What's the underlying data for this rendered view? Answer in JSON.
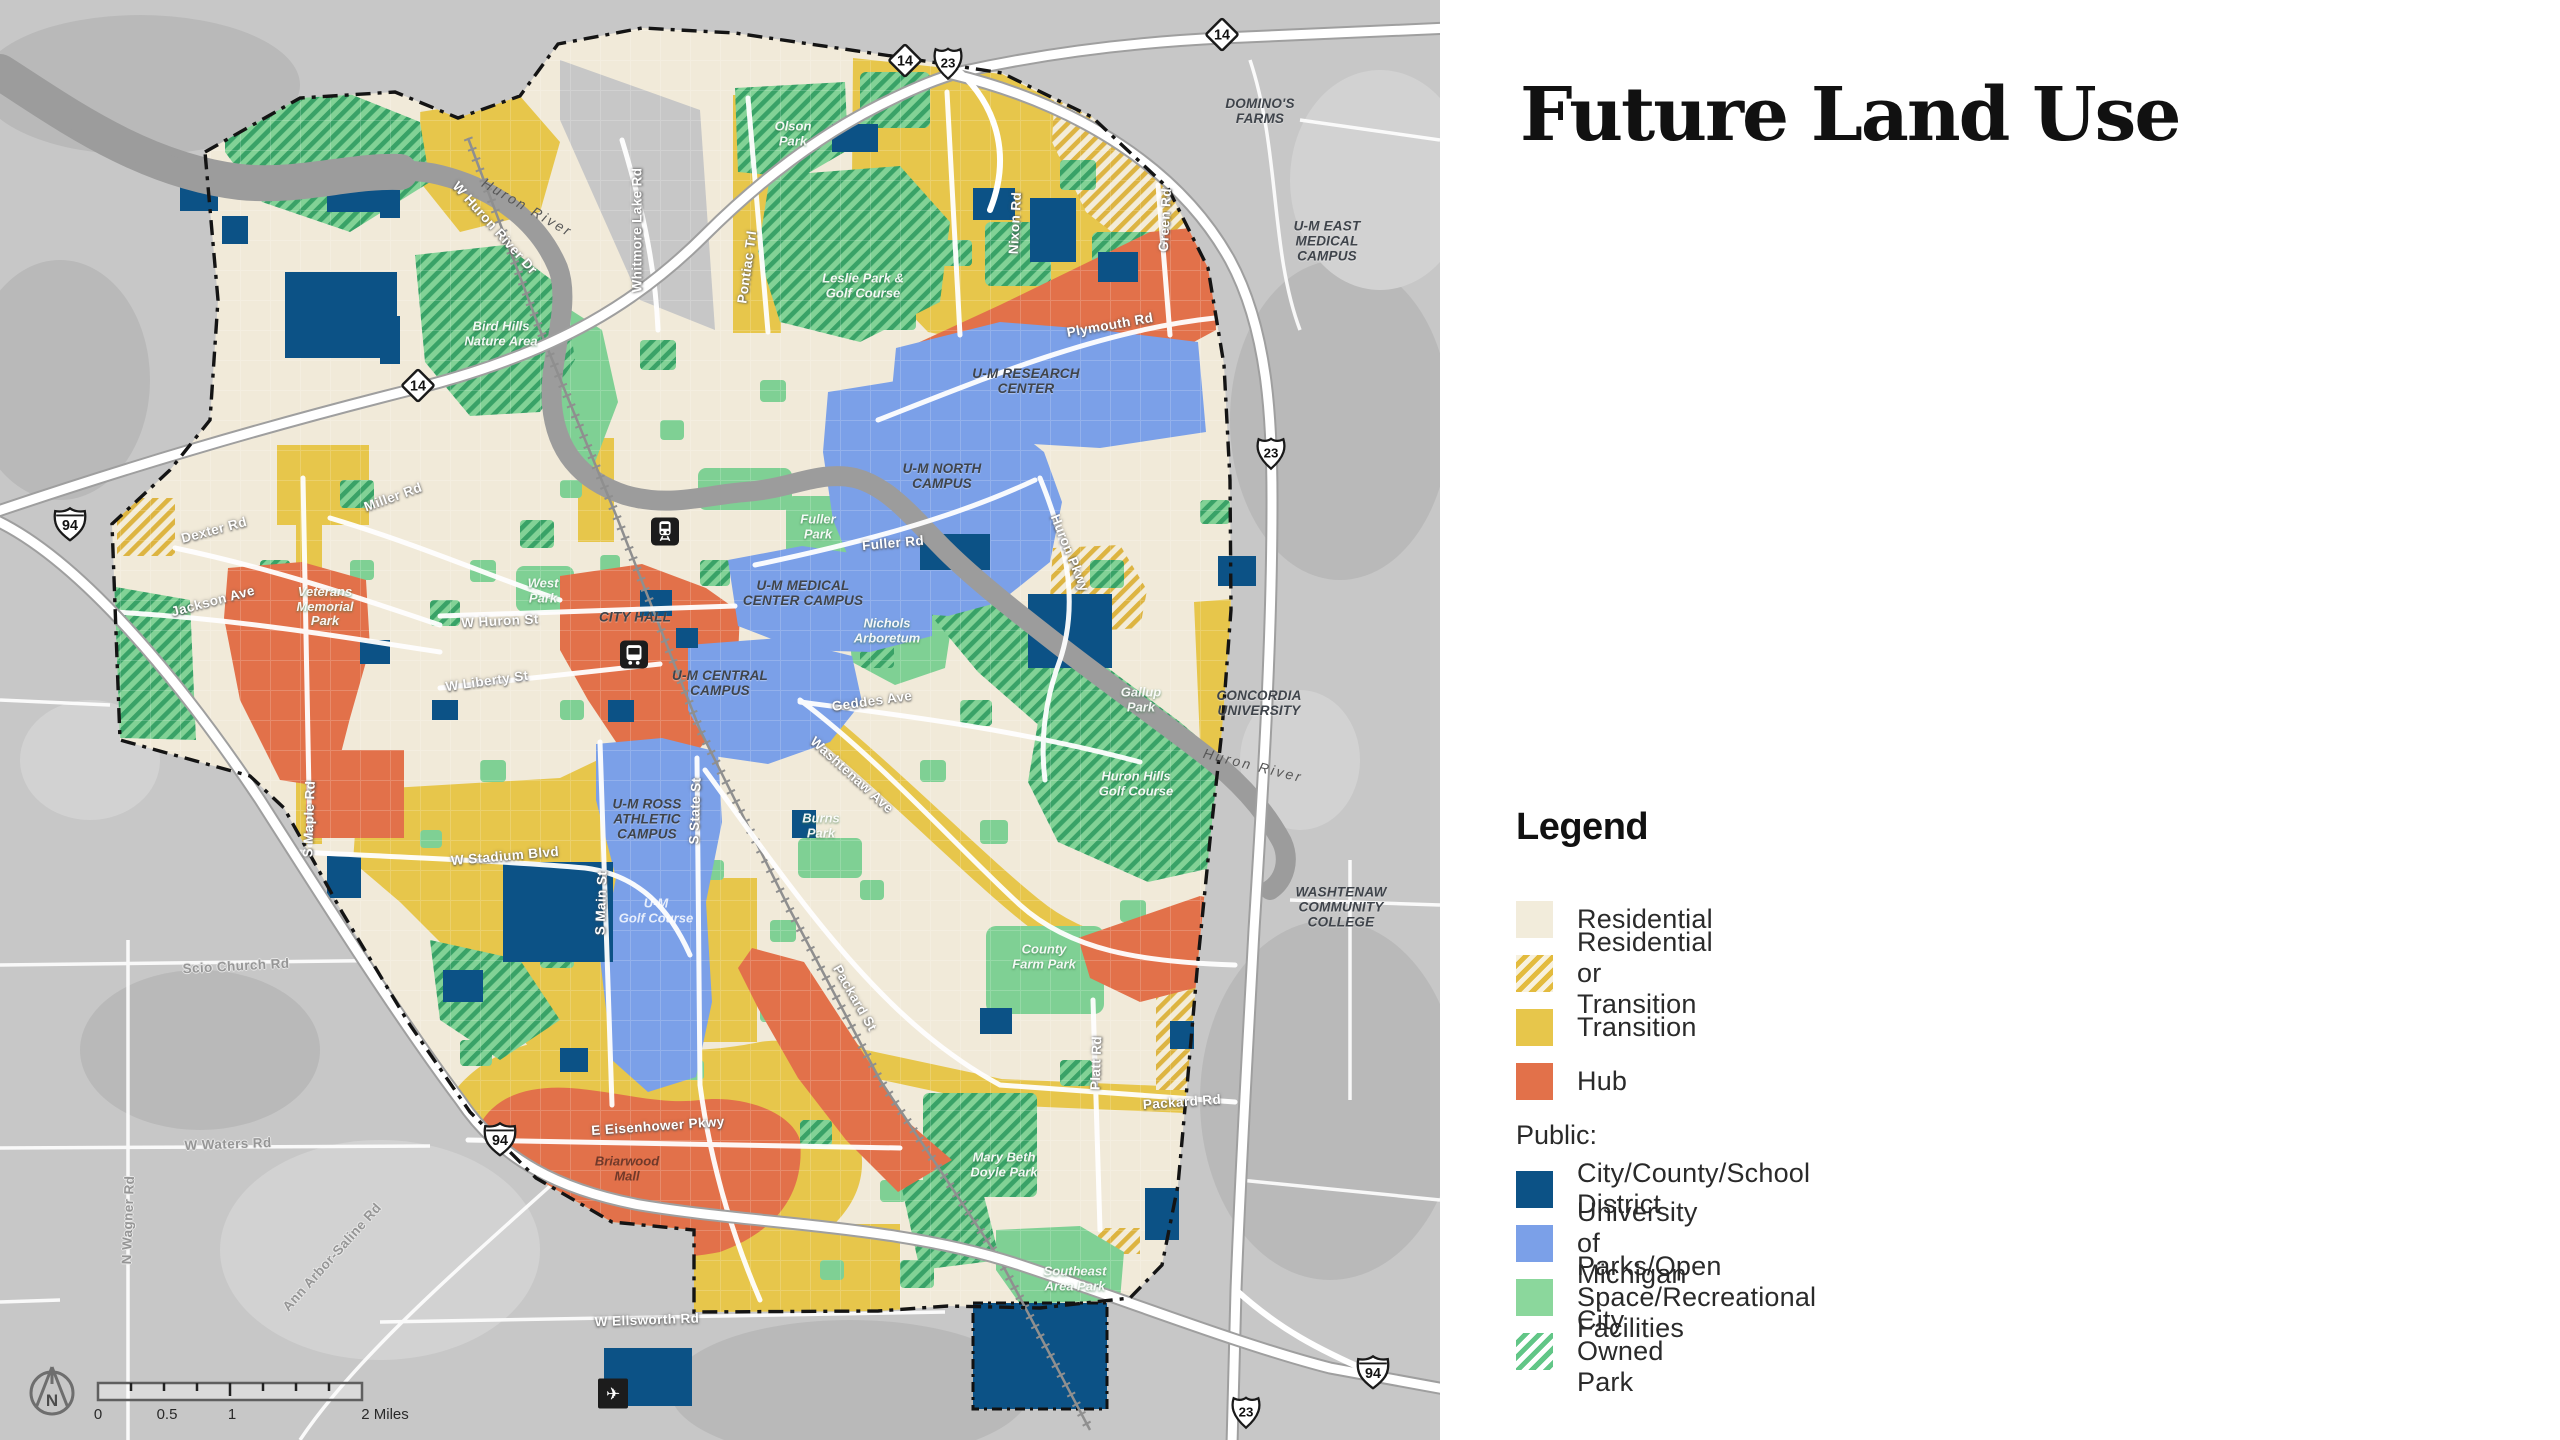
{
  "panel": {
    "title": "Future Land Use",
    "legend": {
      "heading": "Legend",
      "items": [
        {
          "kind": "item",
          "swatch": "residential",
          "label": "Residential"
        },
        {
          "kind": "item",
          "swatch": "residential-or-transition",
          "label": "Residential or Transition"
        },
        {
          "kind": "item",
          "swatch": "transition",
          "label": "Transition"
        },
        {
          "kind": "item",
          "swatch": "hub",
          "label": "Hub"
        },
        {
          "kind": "subheading",
          "label": "Public:"
        },
        {
          "kind": "item",
          "swatch": "city-county-school",
          "label": "City/County/School District"
        },
        {
          "kind": "item",
          "swatch": "university",
          "label": "University of Michigan"
        },
        {
          "kind": "item",
          "swatch": "parks",
          "label": "Parks/Open Space/Recreational Facilities"
        },
        {
          "kind": "item",
          "swatch": "city-owned-park",
          "label": "City Owned Park"
        }
      ]
    }
  },
  "colors": {
    "residential": "#f2ecdb",
    "transition": "#e7c64b",
    "hub": "#e2714a",
    "city_county_school": "#0c5286",
    "university": "#7ba0e8",
    "parks": "#8bd79c",
    "city_owned_park_stripe": "#62c687",
    "res_or_trans_stripe": "#e3bb3e",
    "outside_gray": "#c7c7c7",
    "river_gray": "#9c9c9c"
  },
  "map": {
    "north_label": "N",
    "scale_bar": {
      "labels": [
        "0",
        "0.5",
        "1",
        "2 Miles"
      ]
    },
    "shields": [
      {
        "type": "diamond",
        "text": "14",
        "x": 905,
        "y": 63
      },
      {
        "type": "us",
        "text": "23",
        "x": 948,
        "y": 66
      },
      {
        "type": "diamond",
        "text": "14",
        "x": 1222,
        "y": 37
      },
      {
        "type": "diamond",
        "text": "14",
        "x": 418,
        "y": 388
      },
      {
        "type": "interstate",
        "text": "94",
        "x": 70,
        "y": 527
      },
      {
        "type": "us",
        "text": "23",
        "x": 1271,
        "y": 456
      },
      {
        "type": "interstate",
        "text": "94",
        "x": 500,
        "y": 1142
      },
      {
        "type": "us",
        "text": "23",
        "x": 1246,
        "y": 1415
      },
      {
        "type": "interstate",
        "text": "94",
        "x": 1373,
        "y": 1375
      }
    ],
    "icons": [
      {
        "type": "train",
        "x": 665,
        "y": 534
      },
      {
        "type": "bus",
        "x": 634,
        "y": 657
      },
      {
        "type": "plane",
        "x": 613,
        "y": 1396
      }
    ],
    "labels": [
      {
        "text": "W Huron River Dr",
        "type": "road",
        "x": 495,
        "y": 228,
        "rot": 48
      },
      {
        "text": "Whitmore Lake Rd",
        "type": "road",
        "x": 637,
        "y": 230,
        "rot": -90
      },
      {
        "text": "Pontiac Trl",
        "type": "road",
        "x": 747,
        "y": 267,
        "rot": -82
      },
      {
        "text": "Nixon Rd",
        "type": "road",
        "x": 1015,
        "y": 223,
        "rot": -87
      },
      {
        "text": "Green Rd",
        "type": "road",
        "x": 1165,
        "y": 220,
        "rot": -87
      },
      {
        "text": "Plymouth Rd",
        "type": "road",
        "x": 1110,
        "y": 325,
        "rot": -10
      },
      {
        "text": "Fuller Rd",
        "type": "road",
        "x": 893,
        "y": 543,
        "rot": -5
      },
      {
        "text": "W Huron St",
        "type": "road",
        "x": 500,
        "y": 621,
        "rot": -3
      },
      {
        "text": "W Liberty St",
        "type": "road",
        "x": 487,
        "y": 681,
        "rot": -8
      },
      {
        "text": "Geddes Ave",
        "type": "road",
        "x": 872,
        "y": 701,
        "rot": -8
      },
      {
        "text": "Washtenaw Ave",
        "type": "road",
        "x": 852,
        "y": 775,
        "rot": 42
      },
      {
        "text": "Miller Rd",
        "type": "road",
        "x": 393,
        "y": 497,
        "rot": -20
      },
      {
        "text": "Dexter Rd",
        "type": "road",
        "x": 214,
        "y": 530,
        "rot": -15
      },
      {
        "text": "Jackson Ave",
        "type": "road",
        "x": 213,
        "y": 601,
        "rot": -15
      },
      {
        "text": "S Maple Rd",
        "type": "road",
        "x": 309,
        "y": 819,
        "rot": -88
      },
      {
        "text": "W Stadium Blvd",
        "type": "road",
        "x": 505,
        "y": 856,
        "rot": -5
      },
      {
        "text": "S Main St",
        "type": "road",
        "x": 601,
        "y": 903,
        "rot": -88
      },
      {
        "text": "S State St",
        "type": "road",
        "x": 695,
        "y": 811,
        "rot": -88
      },
      {
        "text": "Packard St",
        "type": "road",
        "x": 855,
        "y": 998,
        "rot": 60
      },
      {
        "text": "Packard Rd",
        "type": "road",
        "x": 1182,
        "y": 1102,
        "rot": -4
      },
      {
        "text": "Platt Rd",
        "type": "road",
        "x": 1096,
        "y": 1063,
        "rot": -88
      },
      {
        "text": "E Eisenhower Pkwy",
        "type": "road",
        "x": 658,
        "y": 1126,
        "rot": -4
      },
      {
        "text": "W Ellsworth Rd",
        "type": "road",
        "x": 647,
        "y": 1320,
        "rot": -2
      },
      {
        "text": "Huron Pkwy",
        "type": "road",
        "x": 1070,
        "y": 553,
        "rot": 68
      },
      {
        "text": "Scio Church Rd",
        "type": "road-out",
        "x": 236,
        "y": 966,
        "rot": -3
      },
      {
        "text": "W Waters Rd",
        "type": "road-out",
        "x": 228,
        "y": 1144,
        "rot": -2
      },
      {
        "text": "N Wagner Rd",
        "type": "road-out",
        "x": 128,
        "y": 1220,
        "rot": -88
      },
      {
        "text": "Ann Arbor-Saline Rd",
        "type": "road-out",
        "x": 332,
        "y": 1257,
        "rot": -48
      },
      {
        "text": "Huron River",
        "type": "river",
        "x": 527,
        "y": 208,
        "rot": 30
      },
      {
        "text": "Huron River",
        "type": "river",
        "x": 1253,
        "y": 766,
        "rot": 14
      },
      {
        "text": "Olson\nPark",
        "type": "park",
        "x": 793,
        "y": 134
      },
      {
        "text": "Leslie Park &\nGolf Course",
        "type": "park",
        "x": 863,
        "y": 286
      },
      {
        "text": "Bird Hills\nNature Area",
        "type": "park",
        "x": 501,
        "y": 334
      },
      {
        "text": "West\nPark",
        "type": "park",
        "x": 543,
        "y": 591
      },
      {
        "text": "Fuller\nPark",
        "type": "park",
        "x": 818,
        "y": 527
      },
      {
        "text": "Nichols\nArboretum",
        "type": "park",
        "x": 887,
        "y": 631
      },
      {
        "text": "Gallup\nPark",
        "type": "park",
        "x": 1141,
        "y": 700
      },
      {
        "text": "Huron Hills\nGolf Course",
        "type": "park",
        "x": 1136,
        "y": 784
      },
      {
        "text": "Burns\nPark",
        "type": "park",
        "x": 821,
        "y": 826
      },
      {
        "text": "County\nFarm Park",
        "type": "park",
        "x": 1044,
        "y": 957
      },
      {
        "text": "Mary Beth\nDoyle Park",
        "type": "park",
        "x": 1004,
        "y": 1165
      },
      {
        "text": "Southeast\nArea Park",
        "type": "park",
        "x": 1075,
        "y": 1279
      },
      {
        "text": "Veterans\nMemorial\nPark",
        "type": "park",
        "x": 325,
        "y": 607
      },
      {
        "text": "U-M\nGolf Course",
        "type": "golf",
        "x": 656,
        "y": 911
      },
      {
        "text": "CITY HALL",
        "type": "campus",
        "x": 635,
        "y": 617
      },
      {
        "text": "U-M MEDICAL\nCENTER CAMPUS",
        "type": "campus",
        "x": 803,
        "y": 593
      },
      {
        "text": "U-M CENTRAL\nCAMPUS",
        "type": "campus",
        "x": 720,
        "y": 683
      },
      {
        "text": "U-M RESEARCH\nCENTER",
        "type": "campus",
        "x": 1026,
        "y": 381
      },
      {
        "text": "U-M NORTH\nCAMPUS",
        "type": "campus",
        "x": 942,
        "y": 476
      },
      {
        "text": "U-M ROSS\nATHLETIC\nCAMPUS",
        "type": "campus",
        "x": 647,
        "y": 819
      },
      {
        "text": "U-M EAST\nMEDICAL CAMPUS",
        "type": "campus",
        "x": 1327,
        "y": 241
      },
      {
        "text": "DOMINO'S\nFARMS",
        "type": "campus",
        "x": 1260,
        "y": 111
      },
      {
        "text": "WASHTENAW\nCOMMUNITY\nCOLLEGE",
        "type": "campus",
        "x": 1341,
        "y": 907
      },
      {
        "text": "CONCORDIA\nUNIVERSITY",
        "type": "campus",
        "x": 1259,
        "y": 703
      },
      {
        "text": "Briarwood\nMall",
        "type": "mall",
        "x": 627,
        "y": 1169
      }
    ]
  }
}
